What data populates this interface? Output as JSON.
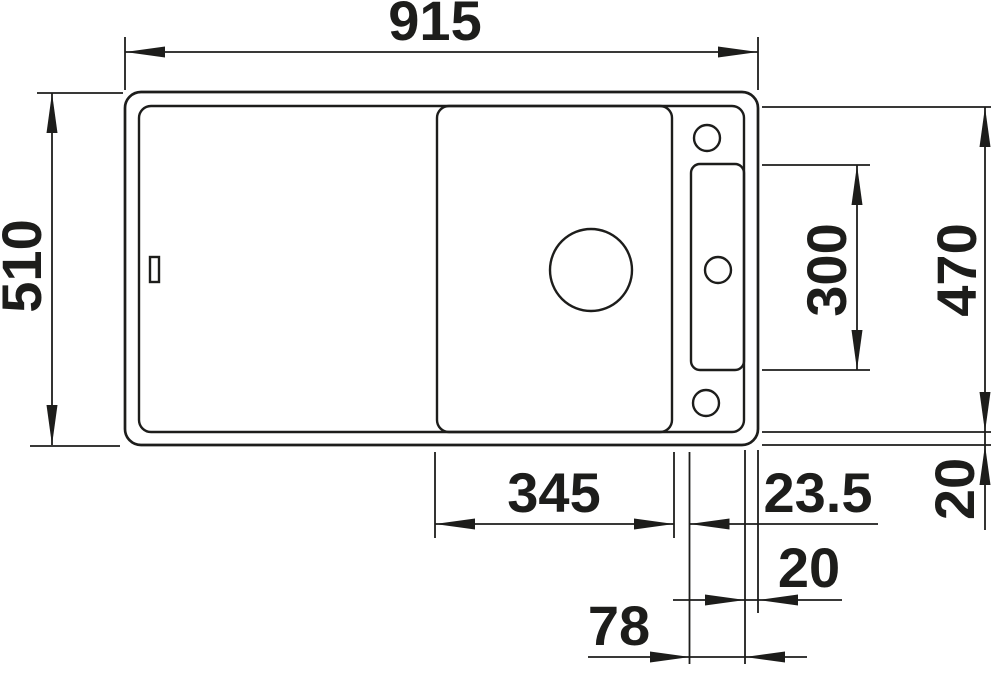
{
  "drawing": {
    "type": "technical-dimension-drawing",
    "subject": "kitchen sink top view",
    "colors": {
      "line": "#1d1d1b",
      "background": "#ffffff"
    },
    "dimensions": {
      "overall_width": {
        "value": "915",
        "orientation": "horizontal",
        "position": "top"
      },
      "overall_depth": {
        "value": "510",
        "orientation": "vertical",
        "position": "left"
      },
      "ledge_length": {
        "value": "300",
        "orientation": "vertical",
        "position": "right-inner"
      },
      "cutout_depth": {
        "value": "470",
        "orientation": "vertical",
        "position": "right-outer"
      },
      "board_section_width": {
        "value": "345",
        "orientation": "horizontal",
        "position": "bottom"
      },
      "divider_width": {
        "value": "23.5",
        "orientation": "horizontal",
        "position": "bottom"
      },
      "rim_width_bottom": {
        "value": "20",
        "orientation": "horizontal",
        "position": "bottom"
      },
      "rim_width_right": {
        "value": "20",
        "orientation": "vertical",
        "position": "bottom-right"
      },
      "ledge_width": {
        "value": "78",
        "orientation": "horizontal",
        "position": "bottom"
      }
    }
  }
}
